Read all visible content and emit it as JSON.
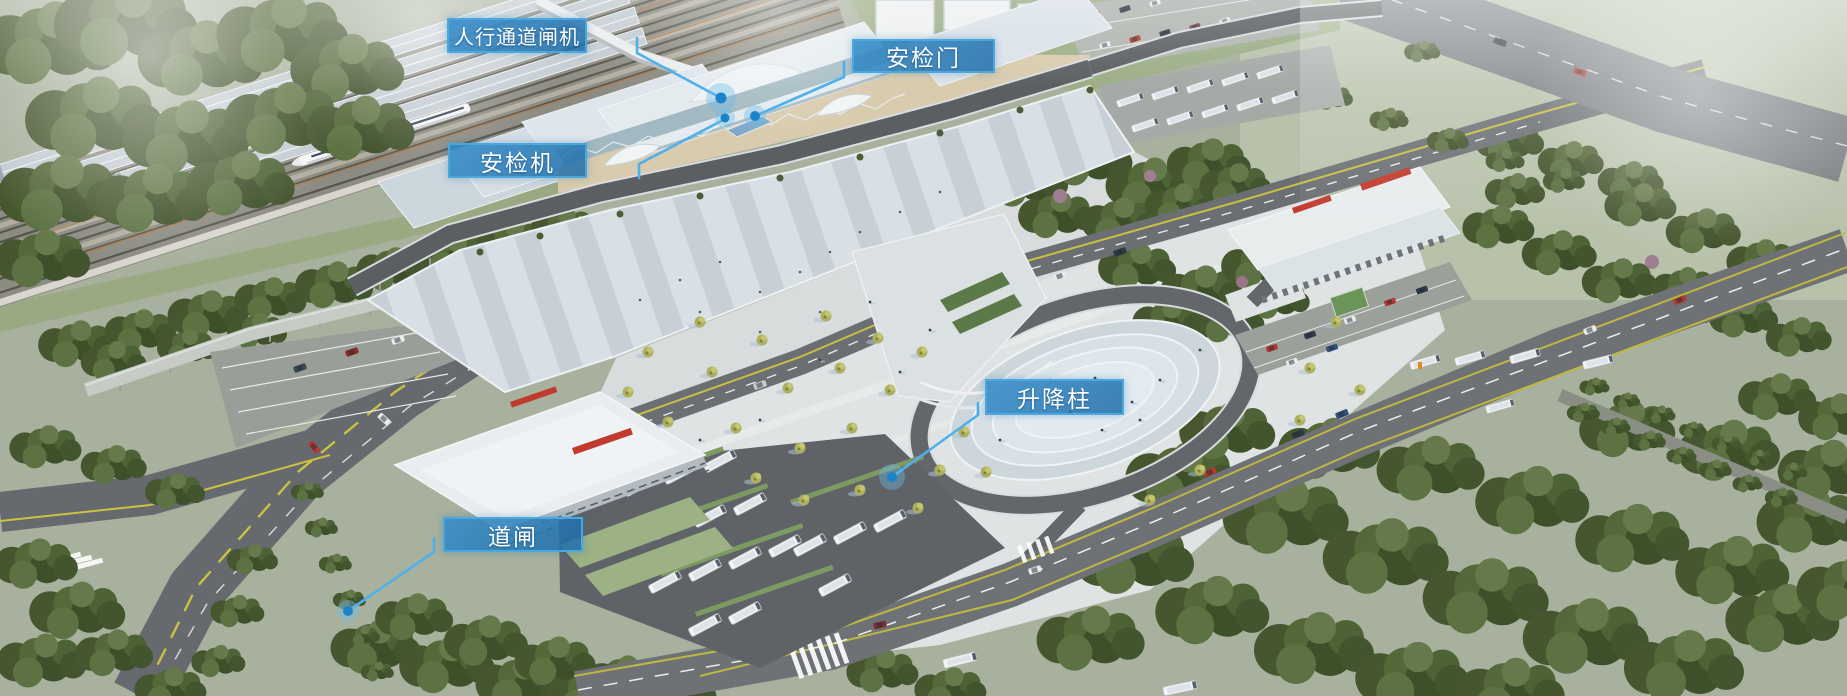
{
  "callouts": [
    {
      "id": "pedestrian-gates",
      "label": "人行通道闸机"
    },
    {
      "id": "security-door",
      "label": "安检门"
    },
    {
      "id": "security-scanner",
      "label": "安检机"
    },
    {
      "id": "lift-bollard",
      "label": "升降柱"
    },
    {
      "id": "road-barrier",
      "label": "道闸"
    }
  ],
  "colors": {
    "callout_fill": "#2f88c7",
    "callout_border": "#49a8e0",
    "callout_text": "#ffffff",
    "leader_line": "#4fb0ea",
    "marker_dot": "#1b84c9",
    "marker_halo": "#6fbce8"
  }
}
